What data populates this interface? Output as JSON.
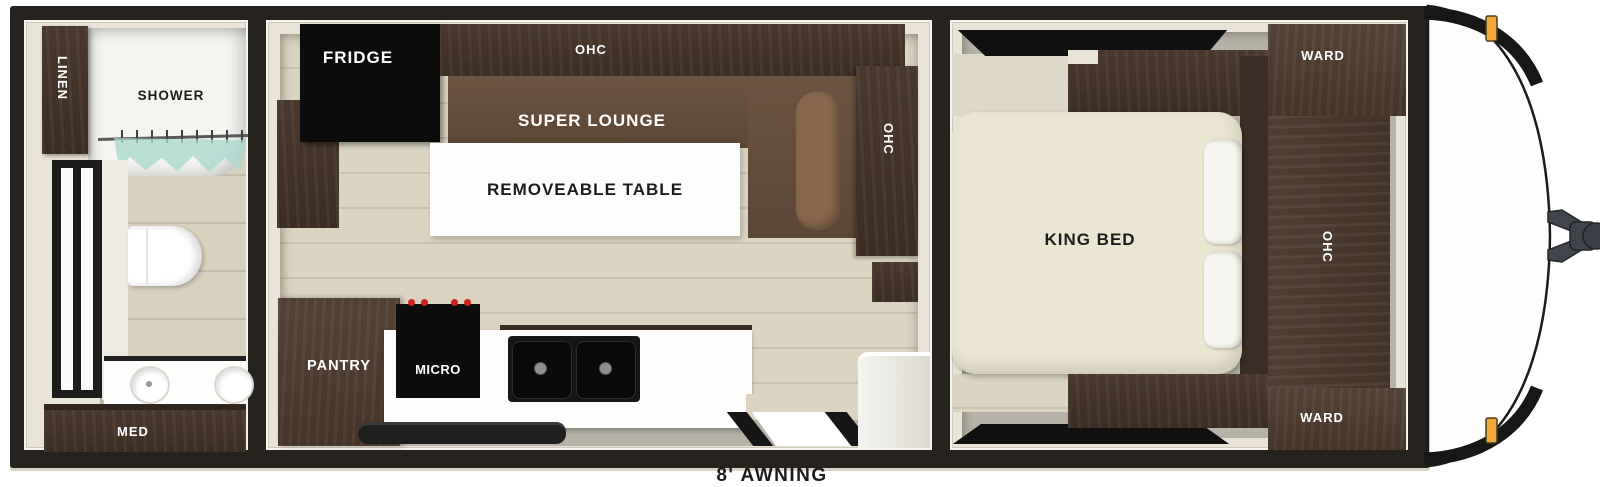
{
  "plan": {
    "awning_label": "8' AWNING",
    "bathroom": {
      "linen": "LINEN",
      "shower": "SHOWER",
      "med": "MED"
    },
    "kitchen": {
      "fridge": "FRIDGE",
      "ohc_top": "OHC",
      "super_lounge": "SUPER LOUNGE",
      "removeable_table": "REMOVEABLE TABLE",
      "ohc_side": "OHC",
      "pantry": "PANTRY",
      "micro": "MICRO"
    },
    "bedroom": {
      "ward_front": "WARD",
      "king_bed": "KING BED",
      "ohc_side": "OHC",
      "ward_rear": "WARD"
    },
    "colors": {
      "wall_black": "#26231f",
      "interior_cream": "#e9e4d7",
      "cabinet_brown": "#4a392e",
      "lounge_brown": "#6d5441",
      "bed_cream": "#ebe6d1",
      "floor_wood": "#d9d3c0",
      "floor_gray": "#b6b2a7",
      "appliance_black": "#0c0c0c",
      "marker_light_amber": "#f0a83c",
      "accent_red_knob": "#cf2318",
      "shower_curtain_teal": "#a9d9cd"
    }
  }
}
